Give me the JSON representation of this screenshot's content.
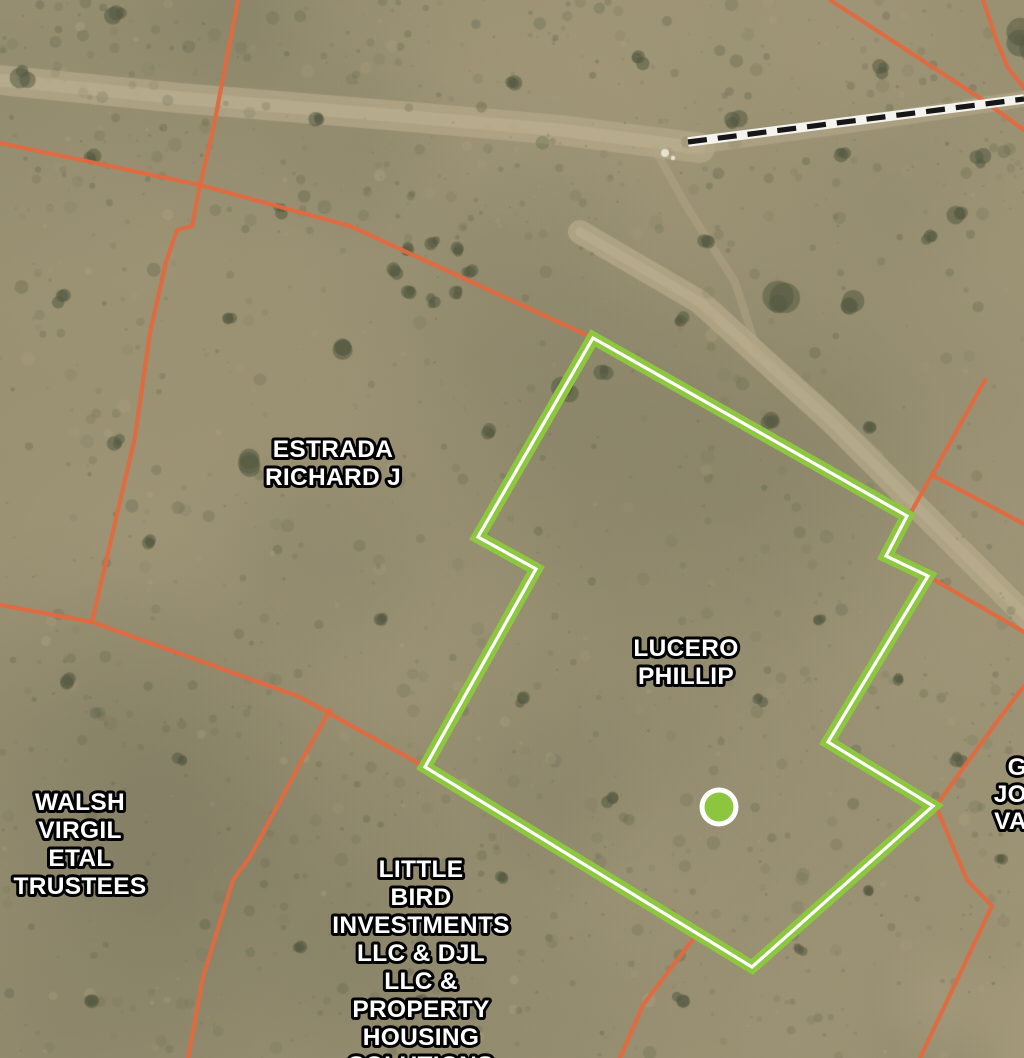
{
  "map": {
    "kind": "satellite-parcel-map",
    "width": 1024,
    "height": 1058
  },
  "colors": {
    "parcel_line": "#e2693f",
    "selected_outline": "#8dc73f",
    "selected_casing": "#ffffff",
    "marker_fill": "#8cc63e",
    "marker_ring": "#ffffff",
    "label_fill": "#ffffff",
    "label_stroke": "#000000",
    "dashed_road_dash": "#161616",
    "dashed_road_casing": "#f5f3ee"
  },
  "selected_parcel": {
    "owner": "LUCERO PHILLIP",
    "outline": [
      [
        593,
        338
      ],
      [
        907,
        516
      ],
      [
        886,
        556
      ],
      [
        928,
        576
      ],
      [
        828,
        742
      ],
      [
        933,
        806
      ],
      [
        752,
        967
      ],
      [
        425,
        767
      ],
      [
        536,
        569
      ],
      [
        478,
        537
      ]
    ],
    "marker": {
      "x": 719,
      "y": 807,
      "r": 14.5,
      "ring": 5
    }
  },
  "parcel_boundaries": [
    {
      "id": "nw-diagonal",
      "points": [
        [
          0,
          143
        ],
        [
          200,
          185
        ],
        [
          350,
          226
        ],
        [
          593,
          338
        ]
      ]
    },
    {
      "id": "n-vertical",
      "points": [
        [
          238,
          0
        ],
        [
          213,
          130
        ],
        [
          200,
          185
        ]
      ]
    },
    {
      "id": "w-mid",
      "points": [
        [
          200,
          185
        ],
        [
          192,
          226
        ],
        [
          177,
          230
        ],
        [
          166,
          262
        ],
        [
          150,
          333
        ],
        [
          135,
          437
        ],
        [
          92,
          622
        ]
      ]
    },
    {
      "id": "w-left-stub",
      "points": [
        [
          0,
          605
        ],
        [
          92,
          622
        ]
      ]
    },
    {
      "id": "w-to-parcel",
      "points": [
        [
          92,
          622
        ],
        [
          300,
          697
        ],
        [
          425,
          767
        ]
      ]
    },
    {
      "id": "walsh-east",
      "points": [
        [
          330,
          710
        ],
        [
          302,
          760
        ],
        [
          250,
          857
        ],
        [
          233,
          880
        ],
        [
          203,
          977
        ],
        [
          188,
          1058
        ]
      ]
    },
    {
      "id": "ne-diagonal",
      "points": [
        [
          830,
          0
        ],
        [
          983,
          100
        ],
        [
          1024,
          130
        ]
      ]
    },
    {
      "id": "ne-curve",
      "points": [
        [
          983,
          0
        ],
        [
          997,
          42
        ],
        [
          1008,
          68
        ],
        [
          1024,
          88
        ]
      ]
    },
    {
      "id": "e-upper",
      "points": [
        [
          985,
          380
        ],
        [
          932,
          475
        ],
        [
          910,
          514
        ]
      ]
    },
    {
      "id": "e-upper-branch",
      "points": [
        [
          932,
          475
        ],
        [
          1024,
          524
        ]
      ]
    },
    {
      "id": "e-mid",
      "points": [
        [
          931,
          578
        ],
        [
          1024,
          632
        ]
      ]
    },
    {
      "id": "e-lower",
      "points": [
        [
          1024,
          686
        ],
        [
          996,
          723
        ],
        [
          938,
          803
        ]
      ]
    },
    {
      "id": "se-boundary",
      "points": [
        [
          936,
          806
        ],
        [
          967,
          880
        ],
        [
          992,
          906
        ],
        [
          920,
          1058
        ]
      ]
    },
    {
      "id": "s-branch",
      "points": [
        [
          700,
          930
        ],
        [
          643,
          1005
        ],
        [
          620,
          1058
        ]
      ]
    }
  ],
  "dashed_road": {
    "points": [
      [
        688,
        142
      ],
      [
        1024,
        99
      ]
    ],
    "dash": 19,
    "gap": 11
  },
  "parcel_labels": [
    {
      "id": "estrada-richard-j",
      "lines": [
        "ESTRADA",
        "RICHARD J"
      ],
      "x": 333,
      "y": 457,
      "line_height": 28,
      "anchor": "middle",
      "font_size": 24.5
    },
    {
      "id": "lucero-phillip",
      "lines": [
        "LUCERO",
        "PHILLIP"
      ],
      "x": 686,
      "y": 656,
      "line_height": 28,
      "anchor": "middle",
      "font_size": 24.5
    },
    {
      "id": "walsh-virgil-etal-trustees",
      "lines": [
        "WALSH",
        "VIRGIL",
        "ETAL",
        "TRUSTEES"
      ],
      "x": 80,
      "y": 810,
      "line_height": 28,
      "anchor": "middle",
      "font_size": 24.5
    },
    {
      "id": "little-bird-investments",
      "lines": [
        "LITTLE",
        "BIRD",
        "INVESTMENTS",
        "LLC & DJL",
        "LLC &",
        "PROPERTY",
        "HOUSING",
        "SOLUTIONS"
      ],
      "x": 421,
      "y": 877,
      "line_height": 28,
      "anchor": "middle",
      "font_size": 24.5
    },
    {
      "id": "right-edge-partial",
      "lines": [
        "G",
        "JO",
        "VA"
      ],
      "x": 1027,
      "y": 775,
      "line_height": 27,
      "anchor": "end",
      "font_size": 24.5
    }
  ]
}
